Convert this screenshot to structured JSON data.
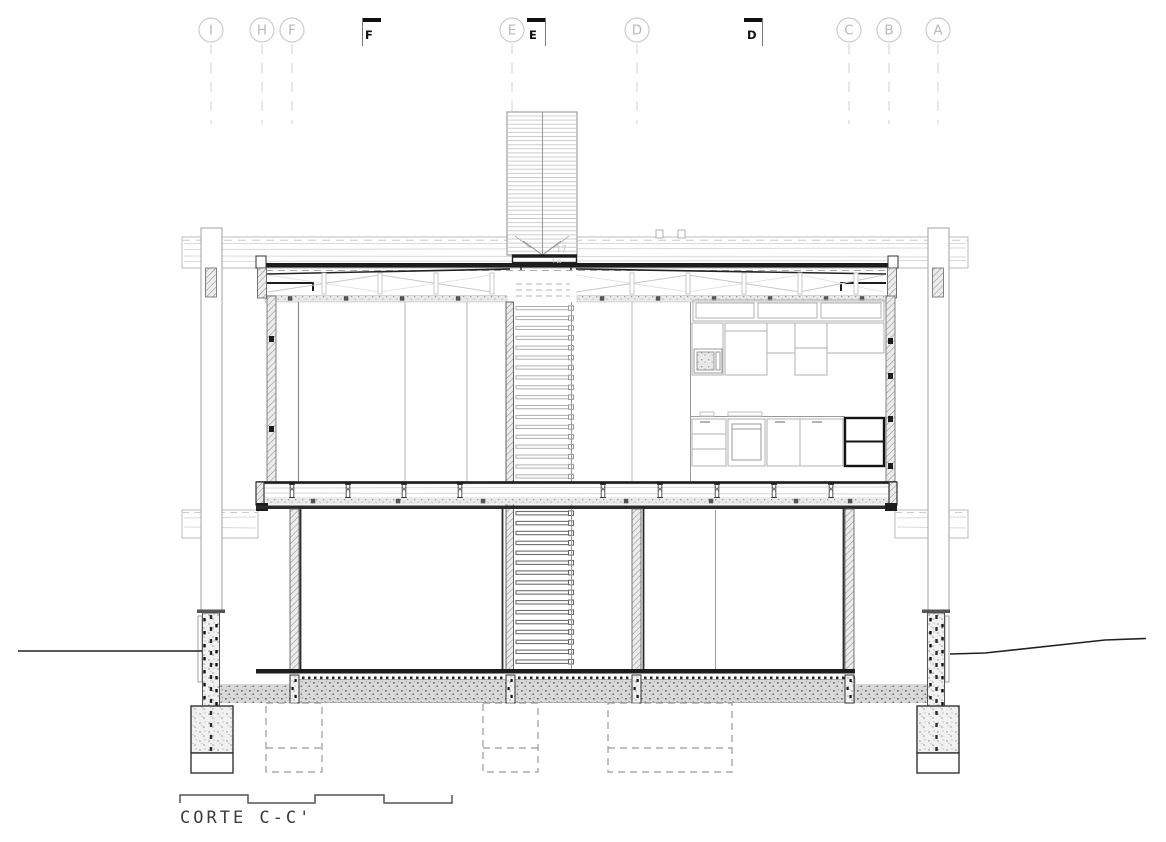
{
  "drawing": {
    "title": "CORTE C-C'",
    "grid": {
      "bubbles": [
        {
          "label": "I",
          "x": 211
        },
        {
          "label": "H",
          "x": 262
        },
        {
          "label": "F",
          "x": 292
        },
        {
          "label": "E",
          "x": 512
        },
        {
          "label": "D",
          "x": 637
        },
        {
          "label": "C",
          "x": 849
        },
        {
          "label": "B",
          "x": 889
        },
        {
          "label": "A",
          "x": 938
        }
      ],
      "section_markers": [
        {
          "label": "F",
          "bar_x": 362,
          "line_x": 362.5,
          "label_x": 365
        },
        {
          "label": "E",
          "bar_x": 527,
          "line_x": 545.5,
          "label_x": 529
        },
        {
          "label": "D",
          "bar_x": 744,
          "line_x": 762.5,
          "label_x": 747
        }
      ]
    },
    "annotations": [
      {
        "text": "17",
        "x": 556,
        "y": 252
      },
      {
        "text": "16",
        "x": 551,
        "y": 266
      }
    ],
    "colors": {
      "cut": "#1c1c1c",
      "medium": "#555555",
      "light": "#b0b0b0",
      "xlight": "#d5d5d5",
      "grid": "#cccccc",
      "title_text": "#3c3c3c"
    }
  }
}
